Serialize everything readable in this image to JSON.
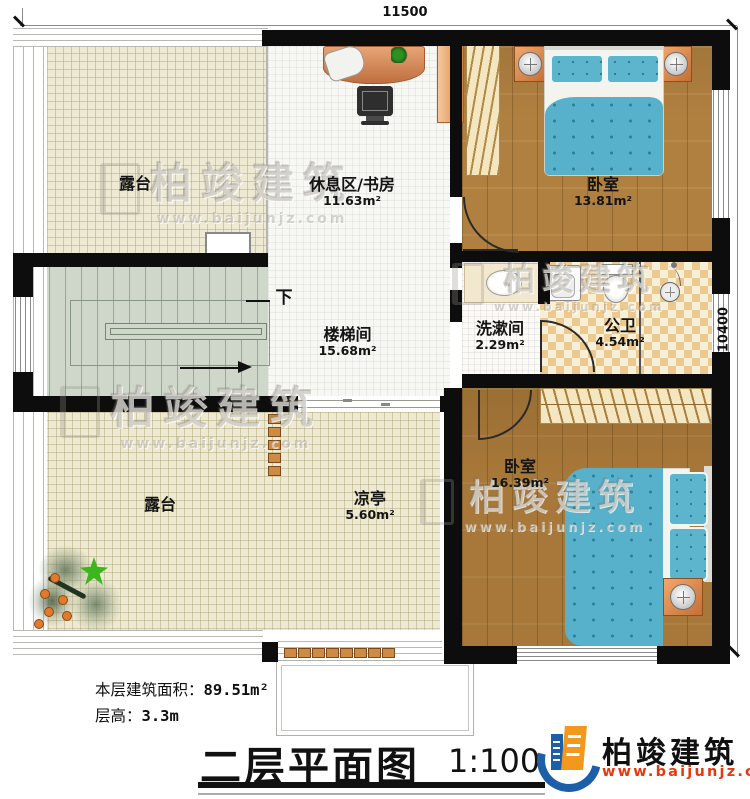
{
  "dimensions": {
    "top": "11500",
    "right": "10400"
  },
  "rooms": {
    "terrace_top": {
      "name": "露台"
    },
    "study": {
      "name": "休息区/书房",
      "area": "11.63m²"
    },
    "bedroom1": {
      "name": "卧室",
      "area": "13.81m²"
    },
    "stairwell": {
      "name": "楼梯间",
      "area": "15.68m²"
    },
    "washroom": {
      "name": "洗漱间",
      "area": "2.29m²"
    },
    "bathroom": {
      "name": "公卫",
      "area": "4.54m²"
    },
    "bedroom2": {
      "name": "卧室",
      "area": "16.39m²"
    },
    "terrace_bottom": {
      "name": "露台"
    },
    "pavilion": {
      "name": "凉亭",
      "area": "5.60m²"
    }
  },
  "stairs": {
    "down_label": "下"
  },
  "notes": {
    "area_label": "本层建筑面积：",
    "area_value": "89.51m²",
    "height_label": "层高：",
    "height_value": "3.3m"
  },
  "title": {
    "text": "二层平面图",
    "scale": "1:100"
  },
  "brand": {
    "name": "柏竣建筑",
    "site": "www.baijunjz.com"
  },
  "watermark": {
    "name": "柏竣建筑",
    "site": "www.baijunjz.com"
  },
  "colors": {
    "wall": "#0d0d0d",
    "terrace_floor": "#ede9d3",
    "wood_floor": "#b08040",
    "tile_checker": "#ecc98f",
    "stair_floor": "#cfd6ca",
    "bed_blue": "#5cb4cd",
    "furniture_orange": "#d9884f",
    "brand_blue": "#1c5fa8",
    "brand_orange": "#f2991d",
    "site_red": "#e8380d"
  }
}
